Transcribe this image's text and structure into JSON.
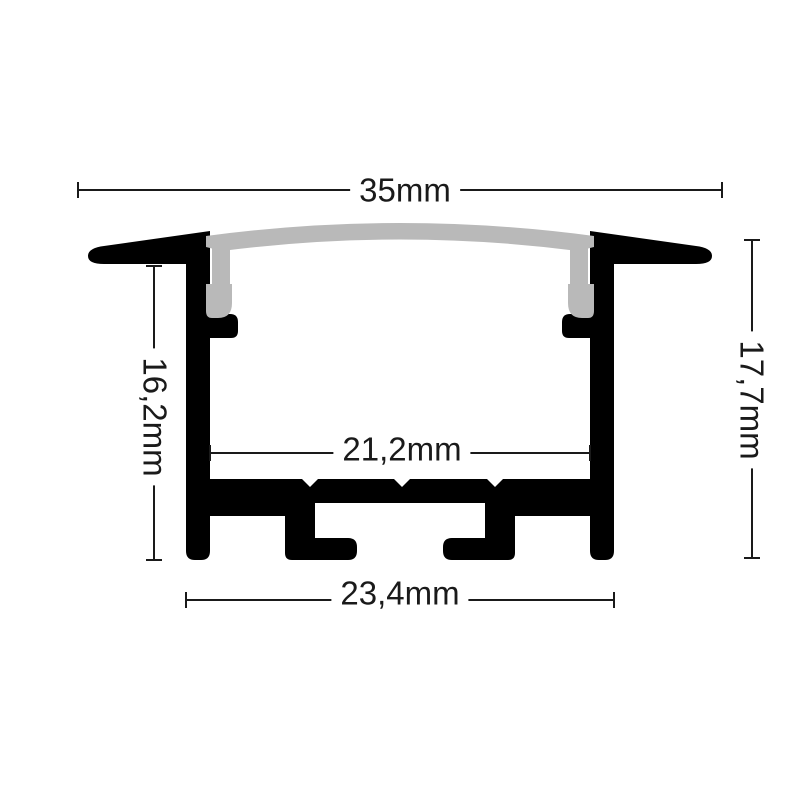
{
  "diagram": {
    "dimensions": {
      "top_width": {
        "label": "35mm"
      },
      "inner_width": {
        "label": "21,2mm"
      },
      "bottom_width": {
        "label": "23,4mm"
      },
      "left_height": {
        "label": "16,2mm"
      },
      "right_height": {
        "label": "17,7mm"
      }
    },
    "colors": {
      "profile_body": "#000000",
      "diffuser": "#b9b9b9",
      "dimension_line": "#1a1a1a",
      "background": "#ffffff"
    }
  }
}
